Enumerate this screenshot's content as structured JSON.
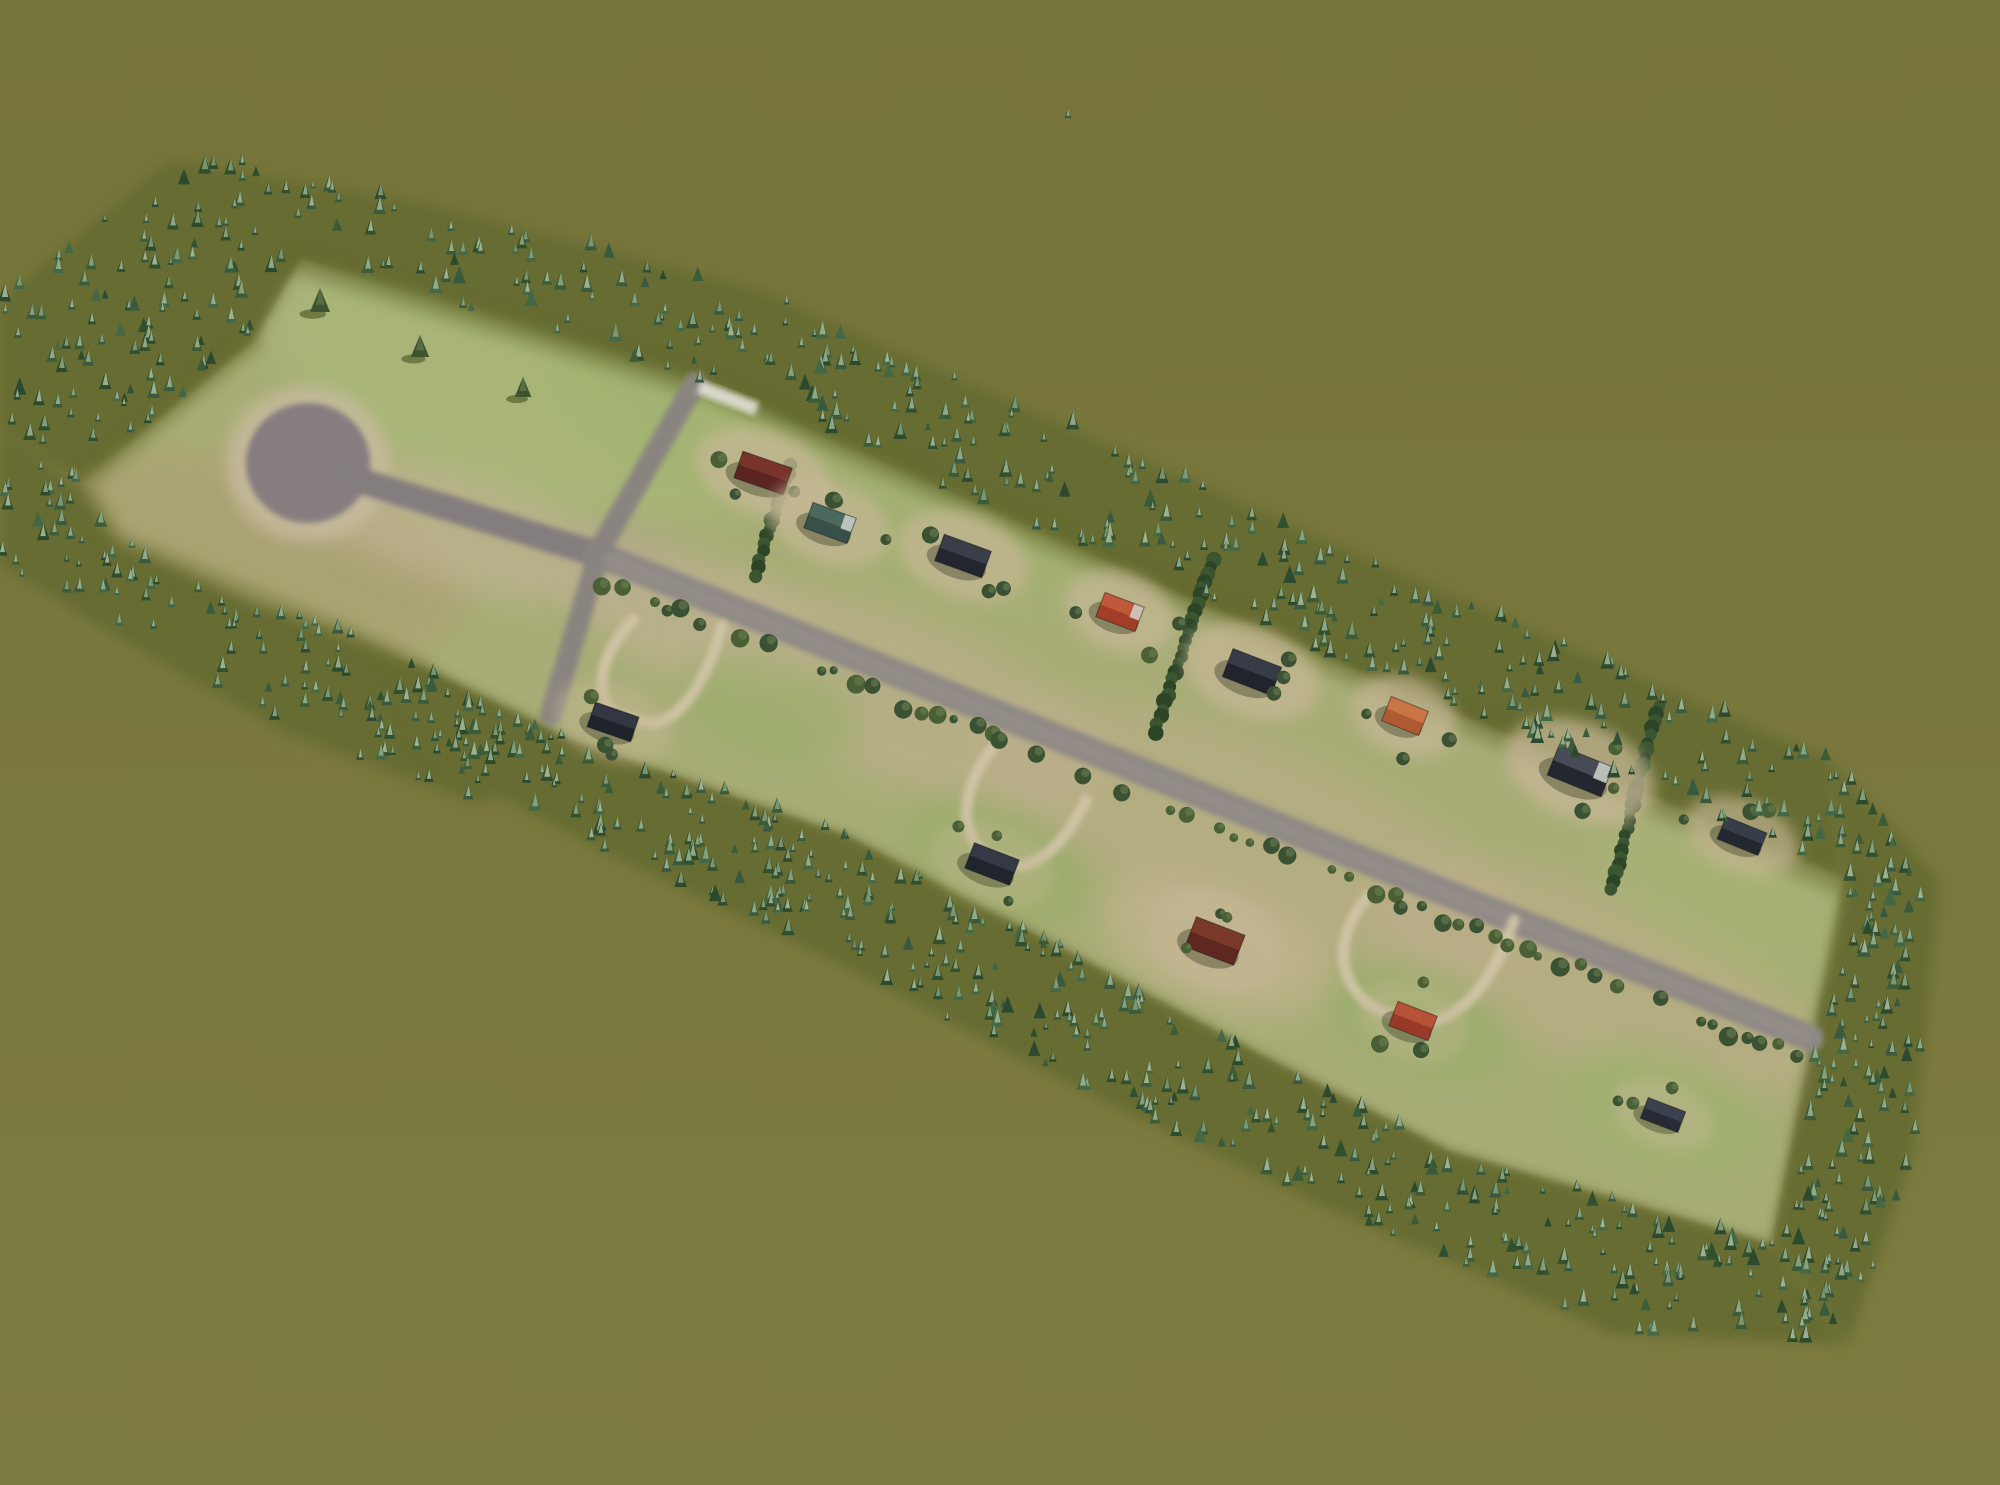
{
  "meta": {
    "app": "city-builder-game",
    "scene": "aerial-rural-subdivision-in-forest-clearing",
    "width": 2000,
    "height": 1485
  },
  "colors": {
    "background_top": "#75743a",
    "background_bottom": "#7e7d41",
    "clearing": "#a8ad77",
    "forest_floor": "#666c30",
    "road_main": "#8e8885",
    "road_cross": "#8a8480",
    "road_stem": "#847d7e",
    "road_worn": "#9e968e",
    "culdesac": "#857d80",
    "apron": "#c7bb9e",
    "driveway": "#d0c5a6",
    "white_pad": "#e8e6df",
    "bush_dark": "#3a5133",
    "bush_mid": "#4a5f35",
    "bush_light": "#6d8150",
    "hedge_dark": "#2d4527",
    "hedge_mid": "#3a5530",
    "tree_bodies": [
      "#31502f",
      "#3c5c39",
      "#2c4a2e",
      "#446845",
      "#3a5a40"
    ],
    "tree_tips": [
      "#93ac84",
      "#a3b792",
      "#87a179",
      "#b0c19c",
      "#9db695"
    ],
    "lone_tree": "#3f5330",
    "lone_tree_shadow": "#4a511f",
    "house_outline": "rgba(20,20,15,0.4)",
    "house_shadow": "rgba(40,45,25,0.35)",
    "house_trim": "#cfd3cc",
    "pad_tan": "#c6b795"
  },
  "clearing": {
    "points": [
      [
        80,
        483
      ],
      [
        253,
        340
      ],
      [
        300,
        258
      ],
      [
        720,
        390
      ],
      [
        1160,
        585
      ],
      [
        1845,
        878
      ],
      [
        1772,
        1245
      ],
      [
        1450,
        1152
      ],
      [
        1260,
        1055
      ],
      [
        1030,
        932
      ],
      [
        850,
        838
      ],
      [
        560,
        737
      ],
      [
        420,
        668
      ],
      [
        360,
        640
      ],
      [
        250,
        600
      ],
      [
        115,
        540
      ]
    ]
  },
  "patches": [
    {
      "cx": 245,
      "cy": 560,
      "rx": 225,
      "ry": 100,
      "rot": 12,
      "color": "#aaa273",
      "opacity": 0.85
    },
    {
      "cx": 520,
      "cy": 395,
      "rx": 260,
      "ry": 105,
      "rot": 18,
      "color": "#a9b878",
      "opacity": 0.8
    },
    {
      "cx": 830,
      "cy": 470,
      "rx": 300,
      "ry": 80,
      "rot": 22,
      "color": "#9fb46c",
      "opacity": 0.45
    },
    {
      "cx": 460,
      "cy": 530,
      "rx": 180,
      "ry": 55,
      "rot": 17,
      "color": "#c2b596",
      "opacity": 0.6
    },
    {
      "cx": 700,
      "cy": 622,
      "rx": 130,
      "ry": 60,
      "rot": 21,
      "color": "#c2b495",
      "opacity": 0.6
    },
    {
      "cx": 900,
      "cy": 700,
      "rx": 220,
      "ry": 80,
      "rot": 22,
      "color": "#bfb08f",
      "opacity": 0.55
    },
    {
      "cx": 1250,
      "cy": 840,
      "rx": 300,
      "ry": 95,
      "rot": 22,
      "color": "#beae8c",
      "opacity": 0.5
    },
    {
      "cx": 1600,
      "cy": 980,
      "rx": 240,
      "ry": 85,
      "rot": 22,
      "color": "#c0ae8d",
      "opacity": 0.5
    },
    {
      "cx": 995,
      "cy": 862,
      "rx": 95,
      "ry": 50,
      "rot": 21,
      "color": "#90ad60",
      "opacity": 0.55
    },
    {
      "cx": 770,
      "cy": 705,
      "rx": 90,
      "ry": 48,
      "rot": 21,
      "color": "#90ad60",
      "opacity": 0.5
    },
    {
      "cx": 1420,
      "cy": 1020,
      "rx": 95,
      "ry": 50,
      "rot": 21,
      "color": "#8fae62",
      "opacity": 0.5
    },
    {
      "cx": 1665,
      "cy": 1110,
      "rx": 100,
      "ry": 55,
      "rot": 21,
      "color": "#99b368",
      "opacity": 0.6
    },
    {
      "cx": 1215,
      "cy": 945,
      "rx": 120,
      "ry": 60,
      "rot": 21,
      "color": "#c6b593",
      "opacity": 0.6
    },
    {
      "cx": 1740,
      "cy": 900,
      "rx": 150,
      "ry": 70,
      "rot": 22,
      "color": "#a7b573",
      "opacity": 0.5
    },
    {
      "cx": 620,
      "cy": 560,
      "rx": 60,
      "ry": 40,
      "rot": 0,
      "color": "#b3a98c",
      "opacity": 0.5
    }
  ],
  "edge_shadows": [
    {
      "pts": [
        [
          300,
          262
        ],
        [
          720,
          392
        ],
        [
          1160,
          587
        ],
        [
          1838,
          882
        ]
      ],
      "w": 26,
      "color": "#5e6428",
      "opacity": 0.4
    },
    {
      "pts": [
        [
          253,
          342
        ],
        [
          84,
          483
        ],
        [
          115,
          540
        ],
        [
          360,
          640
        ],
        [
          420,
          668
        ]
      ],
      "w": 20,
      "color": "#666c2c",
      "opacity": 0.35
    }
  ],
  "forest": {
    "bands": [
      {
        "name": "forest-band-top",
        "trees": 430,
        "smin": 8,
        "smax": 18,
        "points": [
          [
            0,
            300
          ],
          [
            170,
            160
          ],
          [
            430,
            205
          ],
          [
            760,
            290
          ],
          [
            1120,
            450
          ],
          [
            1520,
            625
          ],
          [
            1830,
            760
          ],
          [
            1845,
            878
          ],
          [
            1160,
            585
          ],
          [
            720,
            390
          ],
          [
            300,
            258
          ],
          [
            253,
            340
          ],
          [
            80,
            483
          ],
          [
            0,
            430
          ]
        ]
      },
      {
        "name": "forest-band-left",
        "trees": 120,
        "smin": 8,
        "smax": 17,
        "points": [
          [
            0,
            430
          ],
          [
            80,
            483
          ],
          [
            115,
            540
          ],
          [
            250,
            600
          ],
          [
            360,
            640
          ],
          [
            420,
            668
          ],
          [
            560,
            737
          ],
          [
            480,
            805
          ],
          [
            290,
            735
          ],
          [
            90,
            625
          ],
          [
            0,
            565
          ]
        ]
      },
      {
        "name": "forest-band-bottom",
        "trees": 400,
        "smin": 8,
        "smax": 18,
        "points": [
          [
            420,
            668
          ],
          [
            560,
            737
          ],
          [
            850,
            838
          ],
          [
            1030,
            932
          ],
          [
            1260,
            1055
          ],
          [
            1450,
            1152
          ],
          [
            1772,
            1245
          ],
          [
            1848,
            1345
          ],
          [
            1615,
            1335
          ],
          [
            1320,
            1205
          ],
          [
            1080,
            1090
          ],
          [
            830,
            960
          ],
          [
            610,
            855
          ],
          [
            450,
            770
          ],
          [
            378,
            700
          ]
        ]
      },
      {
        "name": "forest-band-right",
        "trees": 140,
        "smin": 8,
        "smax": 18,
        "points": [
          [
            1830,
            760
          ],
          [
            1940,
            880
          ],
          [
            1915,
            1150
          ],
          [
            1848,
            1345
          ],
          [
            1772,
            1245
          ],
          [
            1845,
            878
          ]
        ]
      }
    ],
    "stray_trees": [
      [
        121,
        272,
        12
      ],
      [
        198,
        212,
        11
      ],
      [
        242,
        165,
        10
      ],
      [
        8,
        490,
        12
      ],
      [
        132,
        548,
        10
      ],
      [
        58,
        350,
        9
      ],
      [
        1068,
        118,
        9
      ]
    ],
    "lone_trees": [
      [
        320,
        312,
        24
      ],
      [
        420,
        357,
        22
      ],
      [
        523,
        397,
        20
      ]
    ]
  },
  "roads": {
    "apron": {
      "cx": 308,
      "cy": 464,
      "rx": 82,
      "ry": 78
    },
    "culdesac_bulb": {
      "cx": 308,
      "cy": 463,
      "rx": 62,
      "ry": 60
    },
    "segments": [
      {
        "name": "culdesac-stem-road",
        "pts": [
          [
            348,
            477
          ],
          [
            600,
            555
          ]
        ],
        "w": 26,
        "color": "road_stem"
      },
      {
        "name": "main-road",
        "pts": [
          [
            600,
            555
          ],
          [
            1810,
            1038
          ]
        ],
        "w": 27,
        "color": "road_main"
      },
      {
        "name": "cross-road",
        "pts": [
          [
            695,
            383
          ],
          [
            600,
            549
          ],
          [
            551,
            715
          ]
        ],
        "w": 22,
        "color": "road_cross"
      }
    ],
    "worn_overlay": {
      "pts": [
        [
          610,
          560
        ],
        [
          1805,
          1036
        ]
      ],
      "w": 14,
      "opacity": 0.35
    },
    "white_pad": {
      "cx": 728,
      "cy": 398,
      "w": 62,
      "h": 14,
      "rot": 21
    },
    "driveways": [
      "M 633 620 C 602 652 590 694 616 714 L 652 724 C 688 718 712 664 722 626",
      "M 993 748 C 962 784 956 834 988 856 L 1022 866 C 1058 856 1076 820 1086 800",
      "M 1368 896 C 1330 940 1336 994 1388 1014 L 1430 1022 C 1480 1010 1502 954 1514 920"
    ]
  },
  "bush_line": {
    "a": [
      610,
      560
    ],
    "b": [
      1805,
      1036
    ],
    "offset": 19,
    "count": 72,
    "skip": 0.25,
    "smin": 4,
    "smax": 10
  },
  "hedges": [
    {
      "a": [
        790,
        465
      ],
      "b": [
        755,
        575
      ]
    },
    {
      "a": [
        1213,
        558
      ],
      "b": [
        1155,
        732
      ]
    },
    {
      "a": [
        1658,
        705
      ],
      "b": [
        1612,
        888
      ]
    }
  ],
  "houses": [
    {
      "id": "house-1-maroon",
      "x": 763,
      "y": 473,
      "w": 52,
      "h": 28,
      "rot": 19,
      "roof": "#5c2420",
      "ridge": "#7b352c",
      "trim": false,
      "pad": 0.75
    },
    {
      "id": "house-2-teal",
      "x": 830,
      "y": 523,
      "w": 46,
      "h": 27,
      "rot": 20,
      "roof": "#37514a",
      "ridge": "#4e6b5e",
      "trim": true,
      "pad": 0.7
    },
    {
      "id": "house-3-navy",
      "x": 963,
      "y": 556,
      "w": 50,
      "h": 28,
      "rot": 20,
      "roof": "#23262e",
      "ridge": "#3c414c",
      "trim": false,
      "pad": 0.7
    },
    {
      "id": "house-4-red",
      "x": 1120,
      "y": 612,
      "w": 42,
      "h": 26,
      "rot": 21,
      "roof": "#a23d28",
      "ridge": "#c25c3b",
      "trim": true,
      "pad": 0.7
    },
    {
      "id": "house-5-navy",
      "x": 1252,
      "y": 672,
      "w": 52,
      "h": 30,
      "rot": 21,
      "roof": "#21242c",
      "ridge": "#3a3f4a",
      "trim": false,
      "pad": 0.7
    },
    {
      "id": "house-6-orange",
      "x": 1405,
      "y": 716,
      "w": 40,
      "h": 26,
      "rot": 22,
      "roof": "#b05a33",
      "ridge": "#cd7847",
      "trim": false,
      "pad": 0.7
    },
    {
      "id": "house-7-navy",
      "x": 1580,
      "y": 771,
      "w": 58,
      "h": 32,
      "rot": 22,
      "roof": "#24272f",
      "ridge": "#4b505a",
      "trim": true,
      "pad": 0.75
    },
    {
      "id": "house-8-navy",
      "x": 1742,
      "y": 836,
      "w": 44,
      "h": 24,
      "rot": 22,
      "roof": "#232730",
      "ridge": "#3b414d",
      "trim": false,
      "pad": 0.65
    },
    {
      "id": "house-9-navy",
      "x": 613,
      "y": 722,
      "w": 46,
      "h": 26,
      "rot": 19,
      "roof": "#1f232b",
      "ridge": "#343a45",
      "trim": false,
      "pad": 0.4
    },
    {
      "id": "house-10-navy",
      "x": 992,
      "y": 864,
      "w": 48,
      "h": 27,
      "rot": 21,
      "roof": "#20242c",
      "ridge": "#373c47",
      "trim": false,
      "pad": 0.4
    },
    {
      "id": "house-11-maroon",
      "x": 1215,
      "y": 941,
      "w": 52,
      "h": 32,
      "rot": 21,
      "roof": "#5e2820",
      "ridge": "#7c3c2a",
      "trim": false,
      "pad": 0.6
    },
    {
      "id": "house-12-red",
      "x": 1413,
      "y": 1021,
      "w": 42,
      "h": 26,
      "rot": 21,
      "roof": "#99392a",
      "ridge": "#b85538",
      "trim": false,
      "pad": 0.4
    },
    {
      "id": "house-13-navy",
      "x": 1663,
      "y": 1115,
      "w": 40,
      "h": 22,
      "rot": 21,
      "roof": "#272b35",
      "ridge": "#3e4451",
      "trim": false,
      "pad": 0.45
    }
  ],
  "house_bushes": {
    "count": 3,
    "rmin": 32,
    "rmax": 62,
    "smin": 5,
    "smax": 9
  }
}
